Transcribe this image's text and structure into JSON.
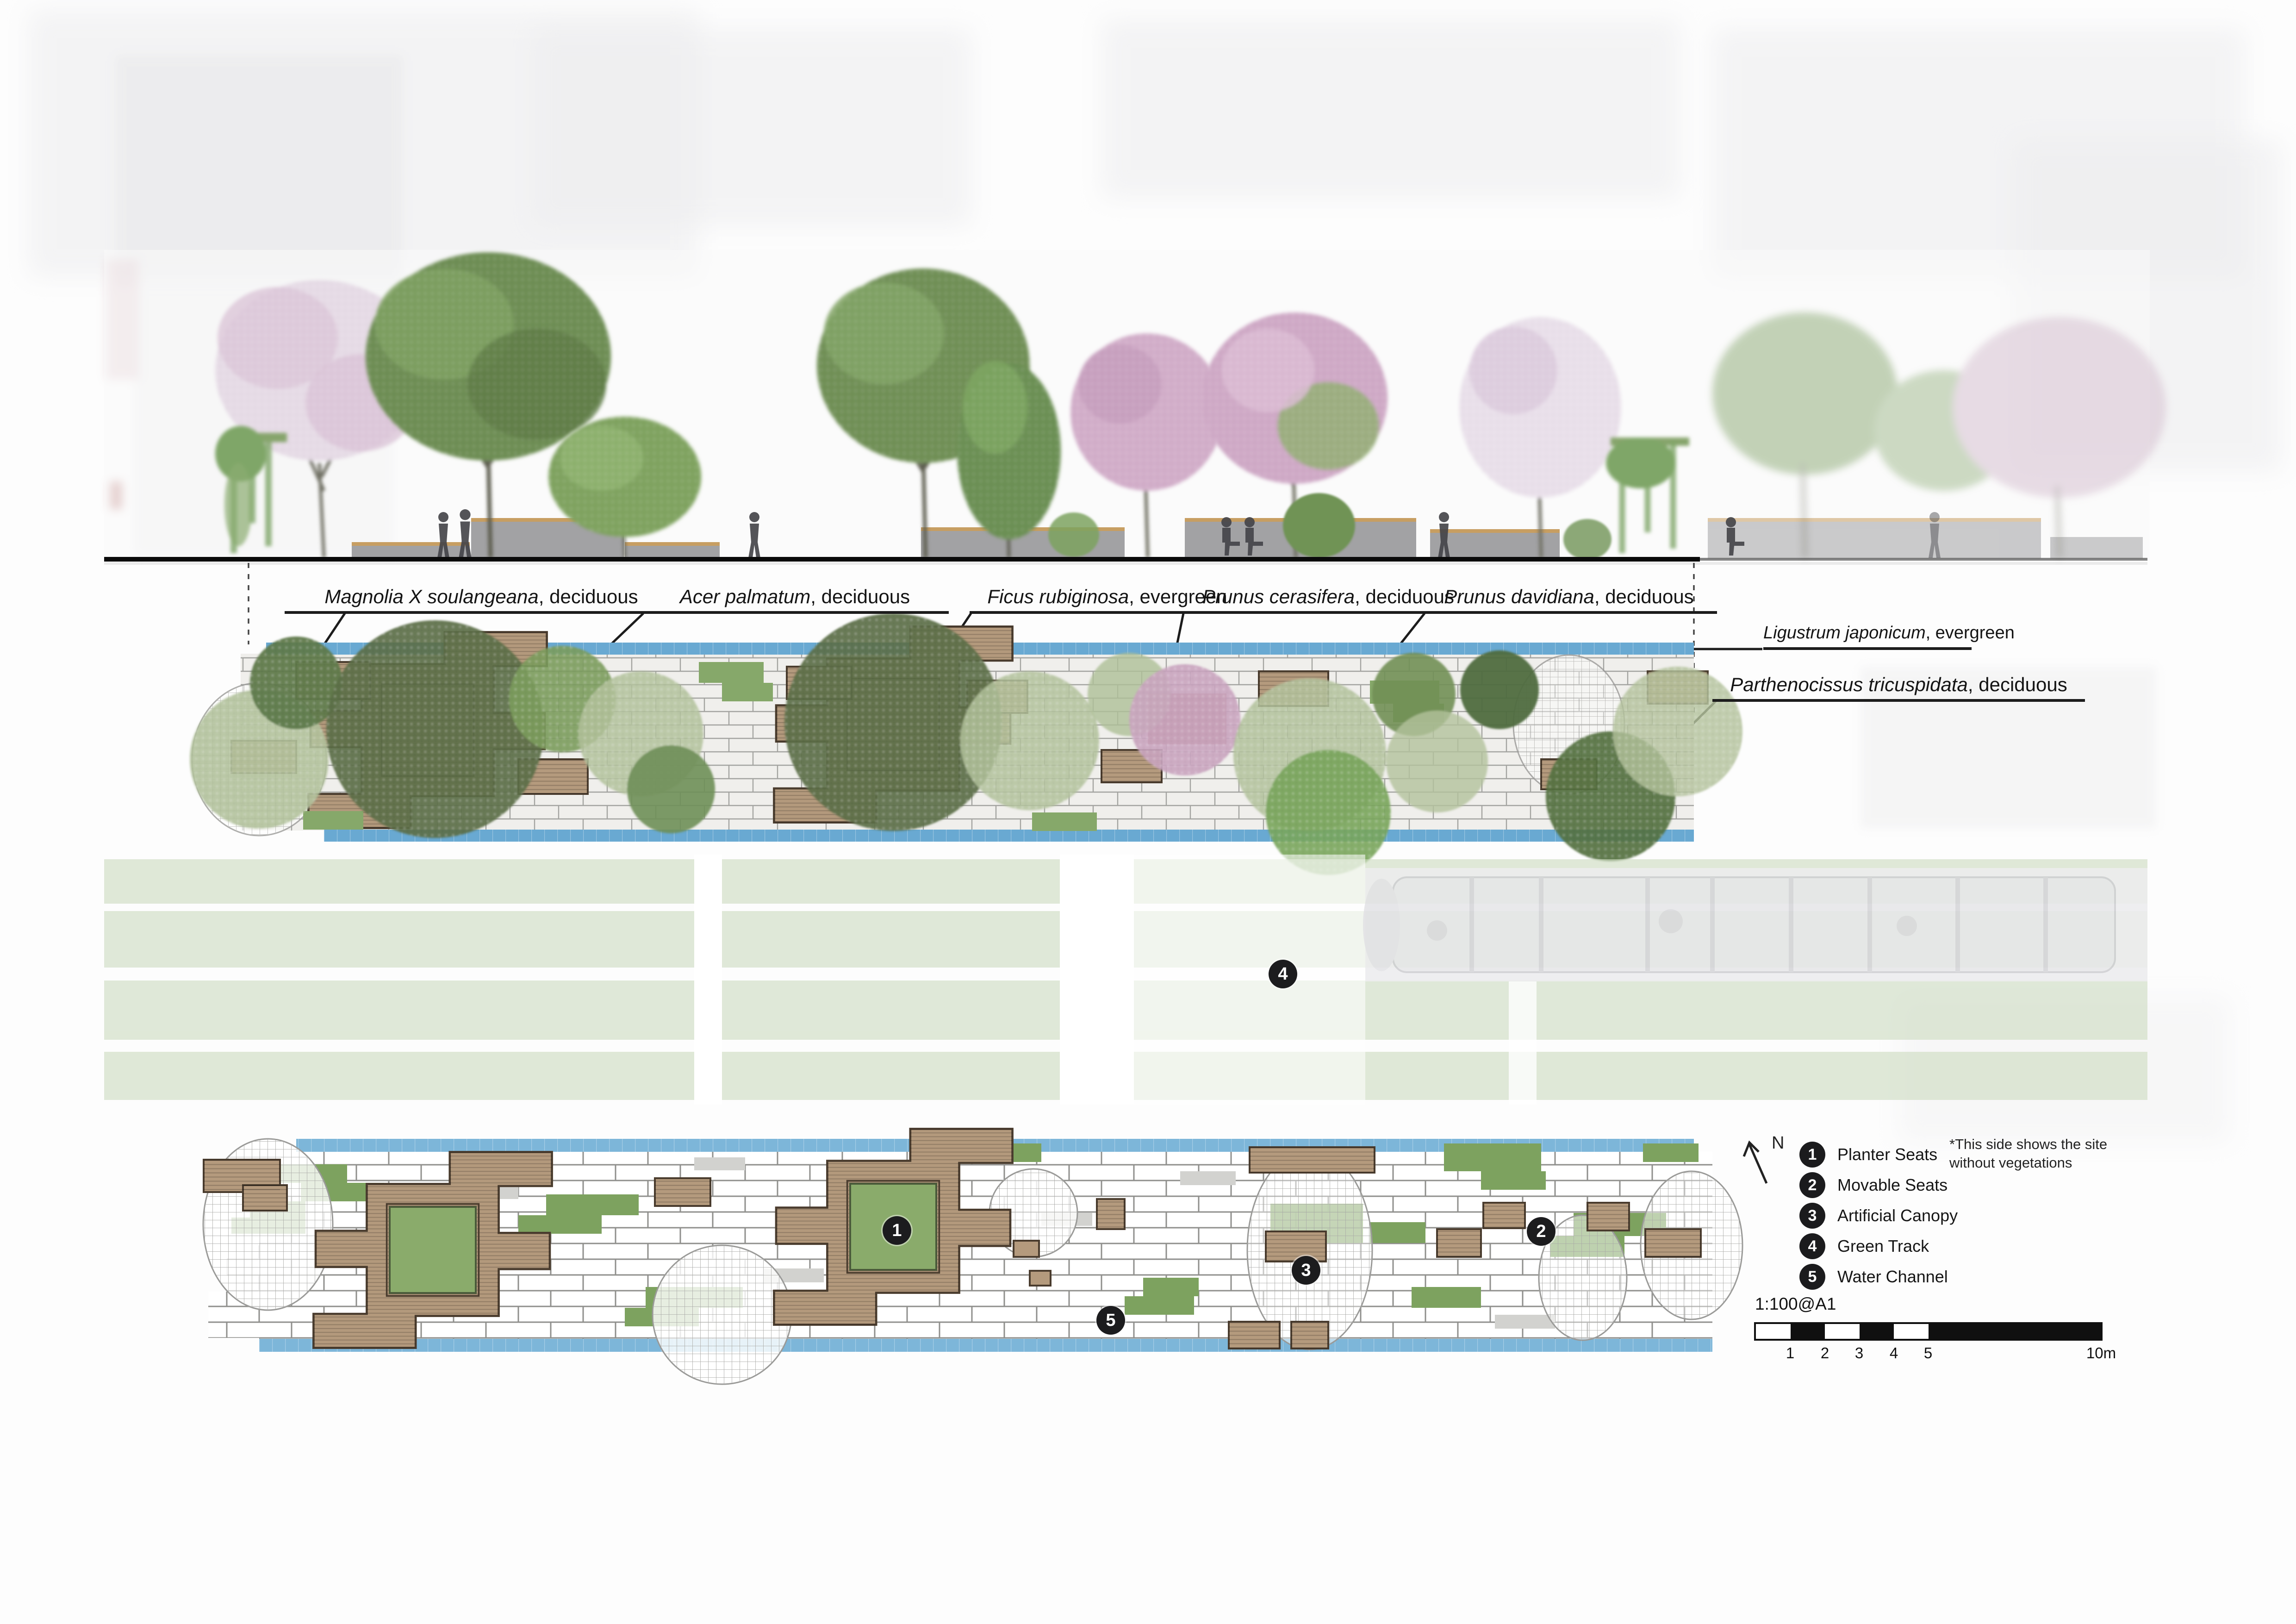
{
  "plant_labels": [
    {
      "species": "Magnolia X soulangeana",
      "type": ", deciduous"
    },
    {
      "species": "Acer palmatum",
      "type": ", deciduous"
    },
    {
      "species": "Ficus rubiginosa",
      "type": ", evergreen"
    },
    {
      "species": "Prunus cerasifera",
      "type": ", deciduous"
    },
    {
      "species": "Prunus davidiana",
      "type": ", deciduous"
    },
    {
      "species": "Ligustrum japonicum",
      "type": ", evergreen"
    },
    {
      "species": "Parthenocissus tricuspidata",
      "type": ", deciduous"
    }
  ],
  "legend": {
    "north_label": "N",
    "items": [
      {
        "num": "1",
        "label": "Planter Seats"
      },
      {
        "num": "2",
        "label": "Movable Seats"
      },
      {
        "num": "3",
        "label": "Artificial Canopy"
      },
      {
        "num": "4",
        "label": "Green Track"
      },
      {
        "num": "5",
        "label": "Water Channel"
      }
    ],
    "note_line1": "*This side shows the site",
    "note_line2": "without vegetations"
  },
  "scale": {
    "label": "1:100@A1",
    "ticks": [
      "1",
      "2",
      "3",
      "4",
      "5",
      "10m"
    ]
  },
  "markers": {
    "m1": "1",
    "m2": "2",
    "m3": "3",
    "m4": "4",
    "m5": "5"
  },
  "colors": {
    "water_channel": "#69a9d2",
    "planter_brown": "#b3997c",
    "green_patch": "#7da25f",
    "green_track": "#ccdabf",
    "marker_black": "#1c1c1e",
    "paving_joint": "#8f8f8c"
  }
}
